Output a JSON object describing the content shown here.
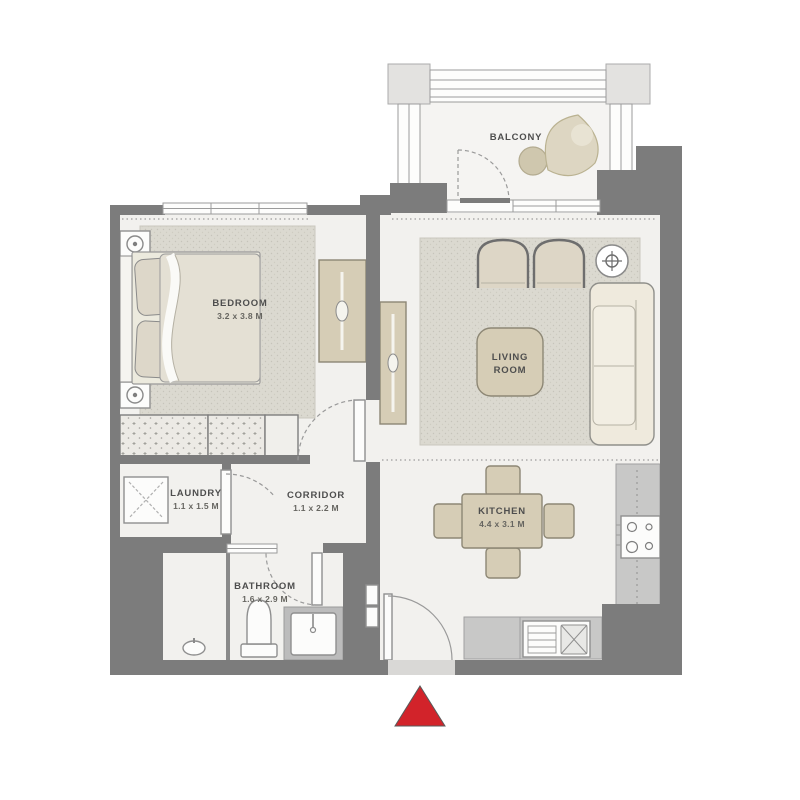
{
  "plan": {
    "type": "apartment-floor-plan",
    "rooms": {
      "balcony": {
        "label": "BALCONY"
      },
      "bedroom": {
        "label": "BEDROOM",
        "dims": "3.2 x 3.8 M"
      },
      "living_room": {
        "label_line_1": "LIVING",
        "label_line_2": "ROOM"
      },
      "corridor": {
        "label": "CORRIDOR",
        "dims": "1.1 x 2.2 M"
      },
      "laundry": {
        "label": "LAUNDRY",
        "dims": "1.1 x 1.5 M"
      },
      "bathroom": {
        "label": "BATHROOM",
        "dims": "1.6 x 2.9 M"
      },
      "kitchen": {
        "label": "KITCHEN",
        "dims": "4.4 x 3.1 M"
      }
    },
    "markers": {
      "entrance": {
        "shape": "red-triangle",
        "meaning": "entrance / orientation marker"
      }
    }
  },
  "colors": {
    "wall": "#7c7c7c",
    "floor": "#f2f1ee",
    "floor_light": "#f5f4f2",
    "rug": "#dbd9d0",
    "beige": "#d6cdb6",
    "beige_dark": "#cfc7ae",
    "cream": "#efeadd",
    "counter": "#c8c8c7",
    "accent_red": "#d2232a",
    "text": "#4e4e4e"
  }
}
